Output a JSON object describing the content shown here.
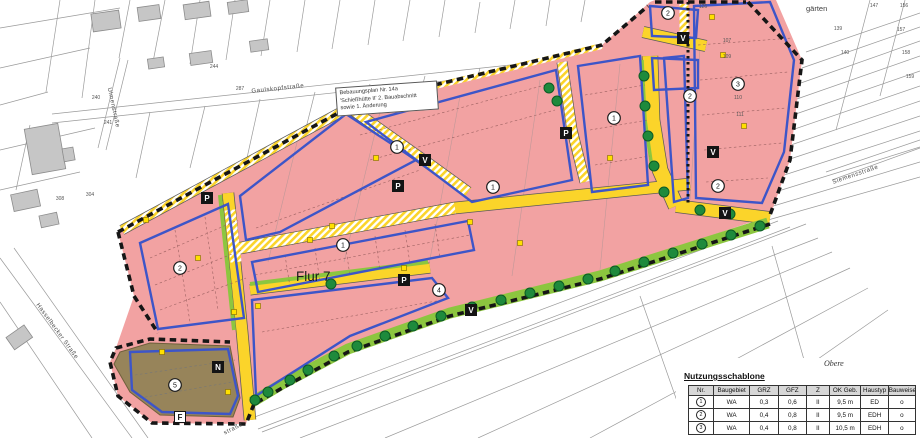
{
  "plan": {
    "info_box": {
      "line1": "Bebauungsplan Nr. 14a",
      "line2": "'Schießhütte II' 2. Bauabschnitt",
      "line3": "sowie 1. Änderung"
    },
    "flur_label": "Flur 7",
    "area_label_top_right": "gärten",
    "streets": [
      {
        "name": "Gaulskopfstraße",
        "x": 278,
        "y": 90,
        "rot": -6
      },
      {
        "name": "Ulmenstraße",
        "x": 112,
        "y": 108,
        "rot": 78
      },
      {
        "name": "Hasselbecker Straße",
        "x": 56,
        "y": 332,
        "rot": 54
      },
      {
        "name": "Siemensstraße",
        "x": 856,
        "y": 176,
        "rot": -19
      },
      {
        "name": "straße",
        "x": 234,
        "y": 430,
        "rot": -27
      }
    ],
    "zone_markers": [
      {
        "n": "1",
        "x": 343,
        "y": 245
      },
      {
        "n": "1",
        "x": 397,
        "y": 147
      },
      {
        "n": "1",
        "x": 493,
        "y": 187
      },
      {
        "n": "1",
        "x": 614,
        "y": 118
      },
      {
        "n": "2",
        "x": 180,
        "y": 268
      },
      {
        "n": "2",
        "x": 668,
        "y": 13
      },
      {
        "n": "2",
        "x": 690,
        "y": 96
      },
      {
        "n": "2",
        "x": 718,
        "y": 186
      },
      {
        "n": "3",
        "x": 738,
        "y": 84
      },
      {
        "n": "4",
        "x": 439,
        "y": 290
      },
      {
        "n": "5",
        "x": 175,
        "y": 385
      }
    ],
    "letter_boxes": [
      {
        "t": "P",
        "x": 207,
        "y": 198
      },
      {
        "t": "P",
        "x": 398,
        "y": 186
      },
      {
        "t": "P",
        "x": 404,
        "y": 280
      },
      {
        "t": "P",
        "x": 566,
        "y": 133
      },
      {
        "t": "V",
        "x": 425,
        "y": 160
      },
      {
        "t": "V",
        "x": 683,
        "y": 38
      },
      {
        "t": "V",
        "x": 713,
        "y": 152
      },
      {
        "t": "V",
        "x": 725,
        "y": 213
      },
      {
        "t": "V",
        "x": 471,
        "y": 310
      },
      {
        "t": "N",
        "x": 218,
        "y": 367
      },
      {
        "t": "F",
        "x": 180,
        "y": 417,
        "light": true
      }
    ],
    "parcel_numbers": [
      {
        "t": "240",
        "x": 96,
        "y": 99
      },
      {
        "t": "241",
        "x": 108,
        "y": 124
      },
      {
        "t": "244",
        "x": 214,
        "y": 68
      },
      {
        "t": "287",
        "x": 240,
        "y": 90
      },
      {
        "t": "304",
        "x": 90,
        "y": 196
      },
      {
        "t": "308",
        "x": 60,
        "y": 200
      },
      {
        "t": "126",
        "x": 703,
        "y": 8
      },
      {
        "t": "107",
        "x": 727,
        "y": 42
      },
      {
        "t": "109",
        "x": 727,
        "y": 58
      },
      {
        "t": "110",
        "x": 738,
        "y": 99
      },
      {
        "t": "111",
        "x": 740,
        "y": 116
      },
      {
        "t": "147",
        "x": 874,
        "y": 7
      },
      {
        "t": "156",
        "x": 904,
        "y": 7
      },
      {
        "t": "139",
        "x": 838,
        "y": 30
      },
      {
        "t": "140",
        "x": 845,
        "y": 54
      },
      {
        "t": "157",
        "x": 901,
        "y": 31
      },
      {
        "t": "158",
        "x": 906,
        "y": 54
      },
      {
        "t": "159",
        "x": 910,
        "y": 78
      }
    ]
  },
  "legend_table": {
    "title": "Nutzungsschablone",
    "annotation": "Obere",
    "headers": [
      "Nr.",
      "Baugebiet",
      "GRZ",
      "GFZ",
      "Z",
      "OK Geb.",
      "Haustyp",
      "Bauweise"
    ],
    "rows": [
      [
        "1",
        "WA",
        "0,3",
        "0,6",
        "II",
        "9,5 m",
        "ED",
        "o"
      ],
      [
        "2",
        "WA",
        "0,4",
        "0,8",
        "II",
        "9,5 m",
        "EDH",
        "o"
      ],
      [
        "3",
        "WA",
        "0,4",
        "0,8",
        "II",
        "10,5 m",
        "EDH",
        "o"
      ]
    ]
  },
  "colors": {
    "zone_fill": "#F2A2A2",
    "road": "#FBD42A",
    "green_strip": "#8CC63F",
    "tree": "#1E8A3C",
    "building_limit_blue": "#3D55C8",
    "plan_boundary": "#161616",
    "playground": "#97845A"
  }
}
